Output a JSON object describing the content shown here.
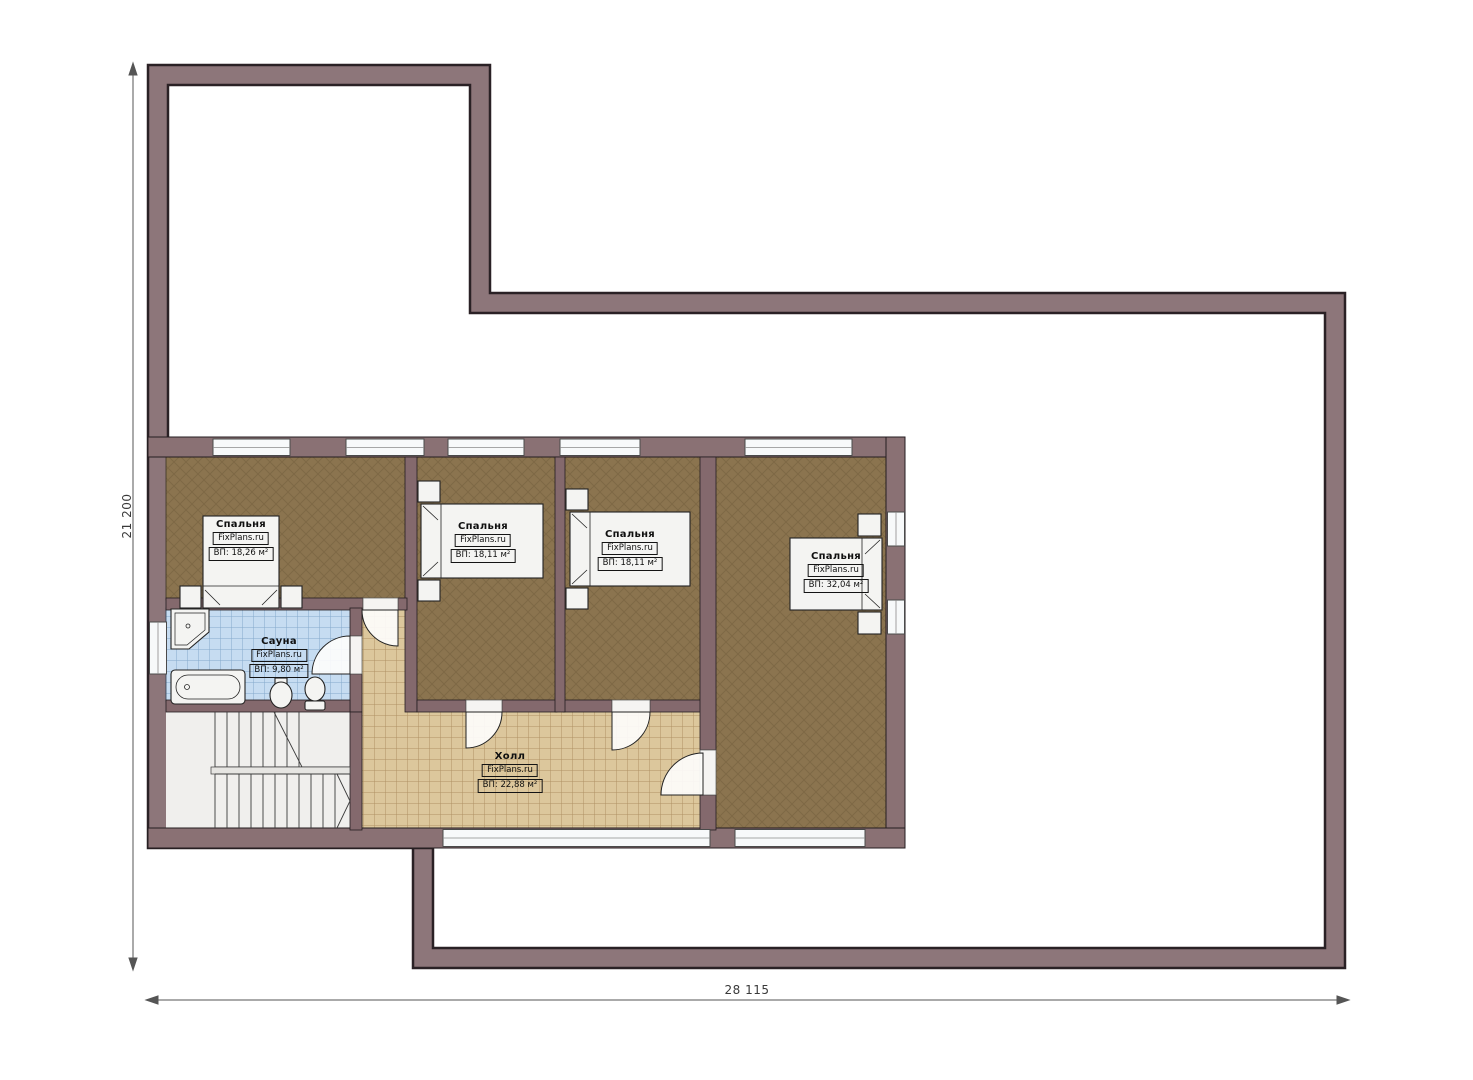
{
  "plan": {
    "rooms": [
      {
        "id": "bedroom-1",
        "name": "Спальня",
        "watermark": "FixPlans.ru",
        "area": "ВП: 18,26 м²"
      },
      {
        "id": "bedroom-2",
        "name": "Спальня",
        "watermark": "FixPlans.ru",
        "area": "ВП: 18,11 м²"
      },
      {
        "id": "bedroom-3",
        "name": "Спальня",
        "watermark": "FixPlans.ru",
        "area": "ВП: 18,11 м²"
      },
      {
        "id": "bedroom-4",
        "name": "Спальня",
        "watermark": "FixPlans.ru",
        "area": "ВП: 32,04 м²"
      },
      {
        "id": "sauna",
        "name": "Сауна",
        "watermark": "FixPlans.ru",
        "area": "ВП: 9,80 м²"
      },
      {
        "id": "hall",
        "name": "Холл",
        "watermark": "FixPlans.ru",
        "area": "ВП: 22,88 м²"
      }
    ],
    "dimensions": {
      "height": "21 200",
      "width": "28 115"
    },
    "colors": {
      "roof_band": "#8d767a",
      "wall": "#8a7174",
      "bedroom_floor": "#8b744f",
      "sauna_tile": "#c6dcf1",
      "hall_tile": "#dcc79c",
      "stair_floor": "#f0efed"
    }
  }
}
